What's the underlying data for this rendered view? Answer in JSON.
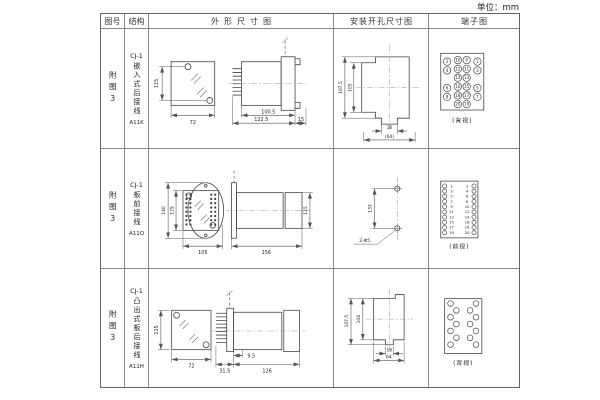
{
  "unit_label": "单位：mm",
  "headers": {
    "fig": "图号",
    "structure": "结构",
    "outline": "外形尺寸图",
    "mounting": "安装开孔尺寸图",
    "terminal": "端子图"
  },
  "rows": [
    {
      "fig": "附图3",
      "structure": {
        "series": "CJ-1",
        "name": "嵌入式后接线",
        "model": "A11K"
      },
      "outline_dims": {
        "front_height": "115",
        "front_width": "72",
        "body_length": "100.5",
        "total_length": "122.5",
        "rear_depth": "15"
      },
      "mounting_dims": {
        "outer_height": "107.5",
        "inner_height": "105",
        "slot_width": "16",
        "hole_span": "(64)"
      },
      "terminal": {
        "view_label": "(背视)",
        "outer_left": [
          "2",
          "4",
          "6",
          "8"
        ],
        "inner_left": [
          "10",
          "12",
          "14",
          "16",
          "18",
          "20"
        ],
        "inner_right": [
          "9",
          "11",
          "13",
          "15",
          "17",
          "19"
        ],
        "outer_right": [
          "1",
          "3",
          "5",
          "7"
        ]
      }
    },
    {
      "fig": "附图3",
      "structure": {
        "series": "CJ-1",
        "name": "板前接线",
        "model": "A11Q"
      },
      "outline_dims": {
        "outer_height": "140",
        "inner_height": "125",
        "front_width": "105",
        "side_length": "156",
        "side_height": "115"
      },
      "mounting_dims": {
        "hole_spacing": "133",
        "holes_label": "2-Φ5"
      },
      "terminal": {
        "view_label": "(前视)",
        "left": [
          "1",
          "3",
          "5",
          "7",
          "9",
          "11",
          "13",
          "15",
          "17",
          "19"
        ],
        "right": [
          "2",
          "4",
          "6",
          "8",
          "10",
          "12",
          "14",
          "16",
          "18",
          "20"
        ]
      }
    },
    {
      "fig": "附图3",
      "structure": {
        "series": "CJ-1",
        "name": "凸出式板后接线",
        "model": "A11H"
      },
      "outline_dims": {
        "front_height": "115",
        "front_width": "72",
        "pin_length": "31.5",
        "flange_depth": "9.5",
        "body_length": "126"
      },
      "mounting_dims": {
        "outer_height": "107.5",
        "inner_height": "104",
        "slot_width": "16",
        "hole_span": "64"
      },
      "terminal": {
        "view_label": "(背视)"
      }
    }
  ]
}
